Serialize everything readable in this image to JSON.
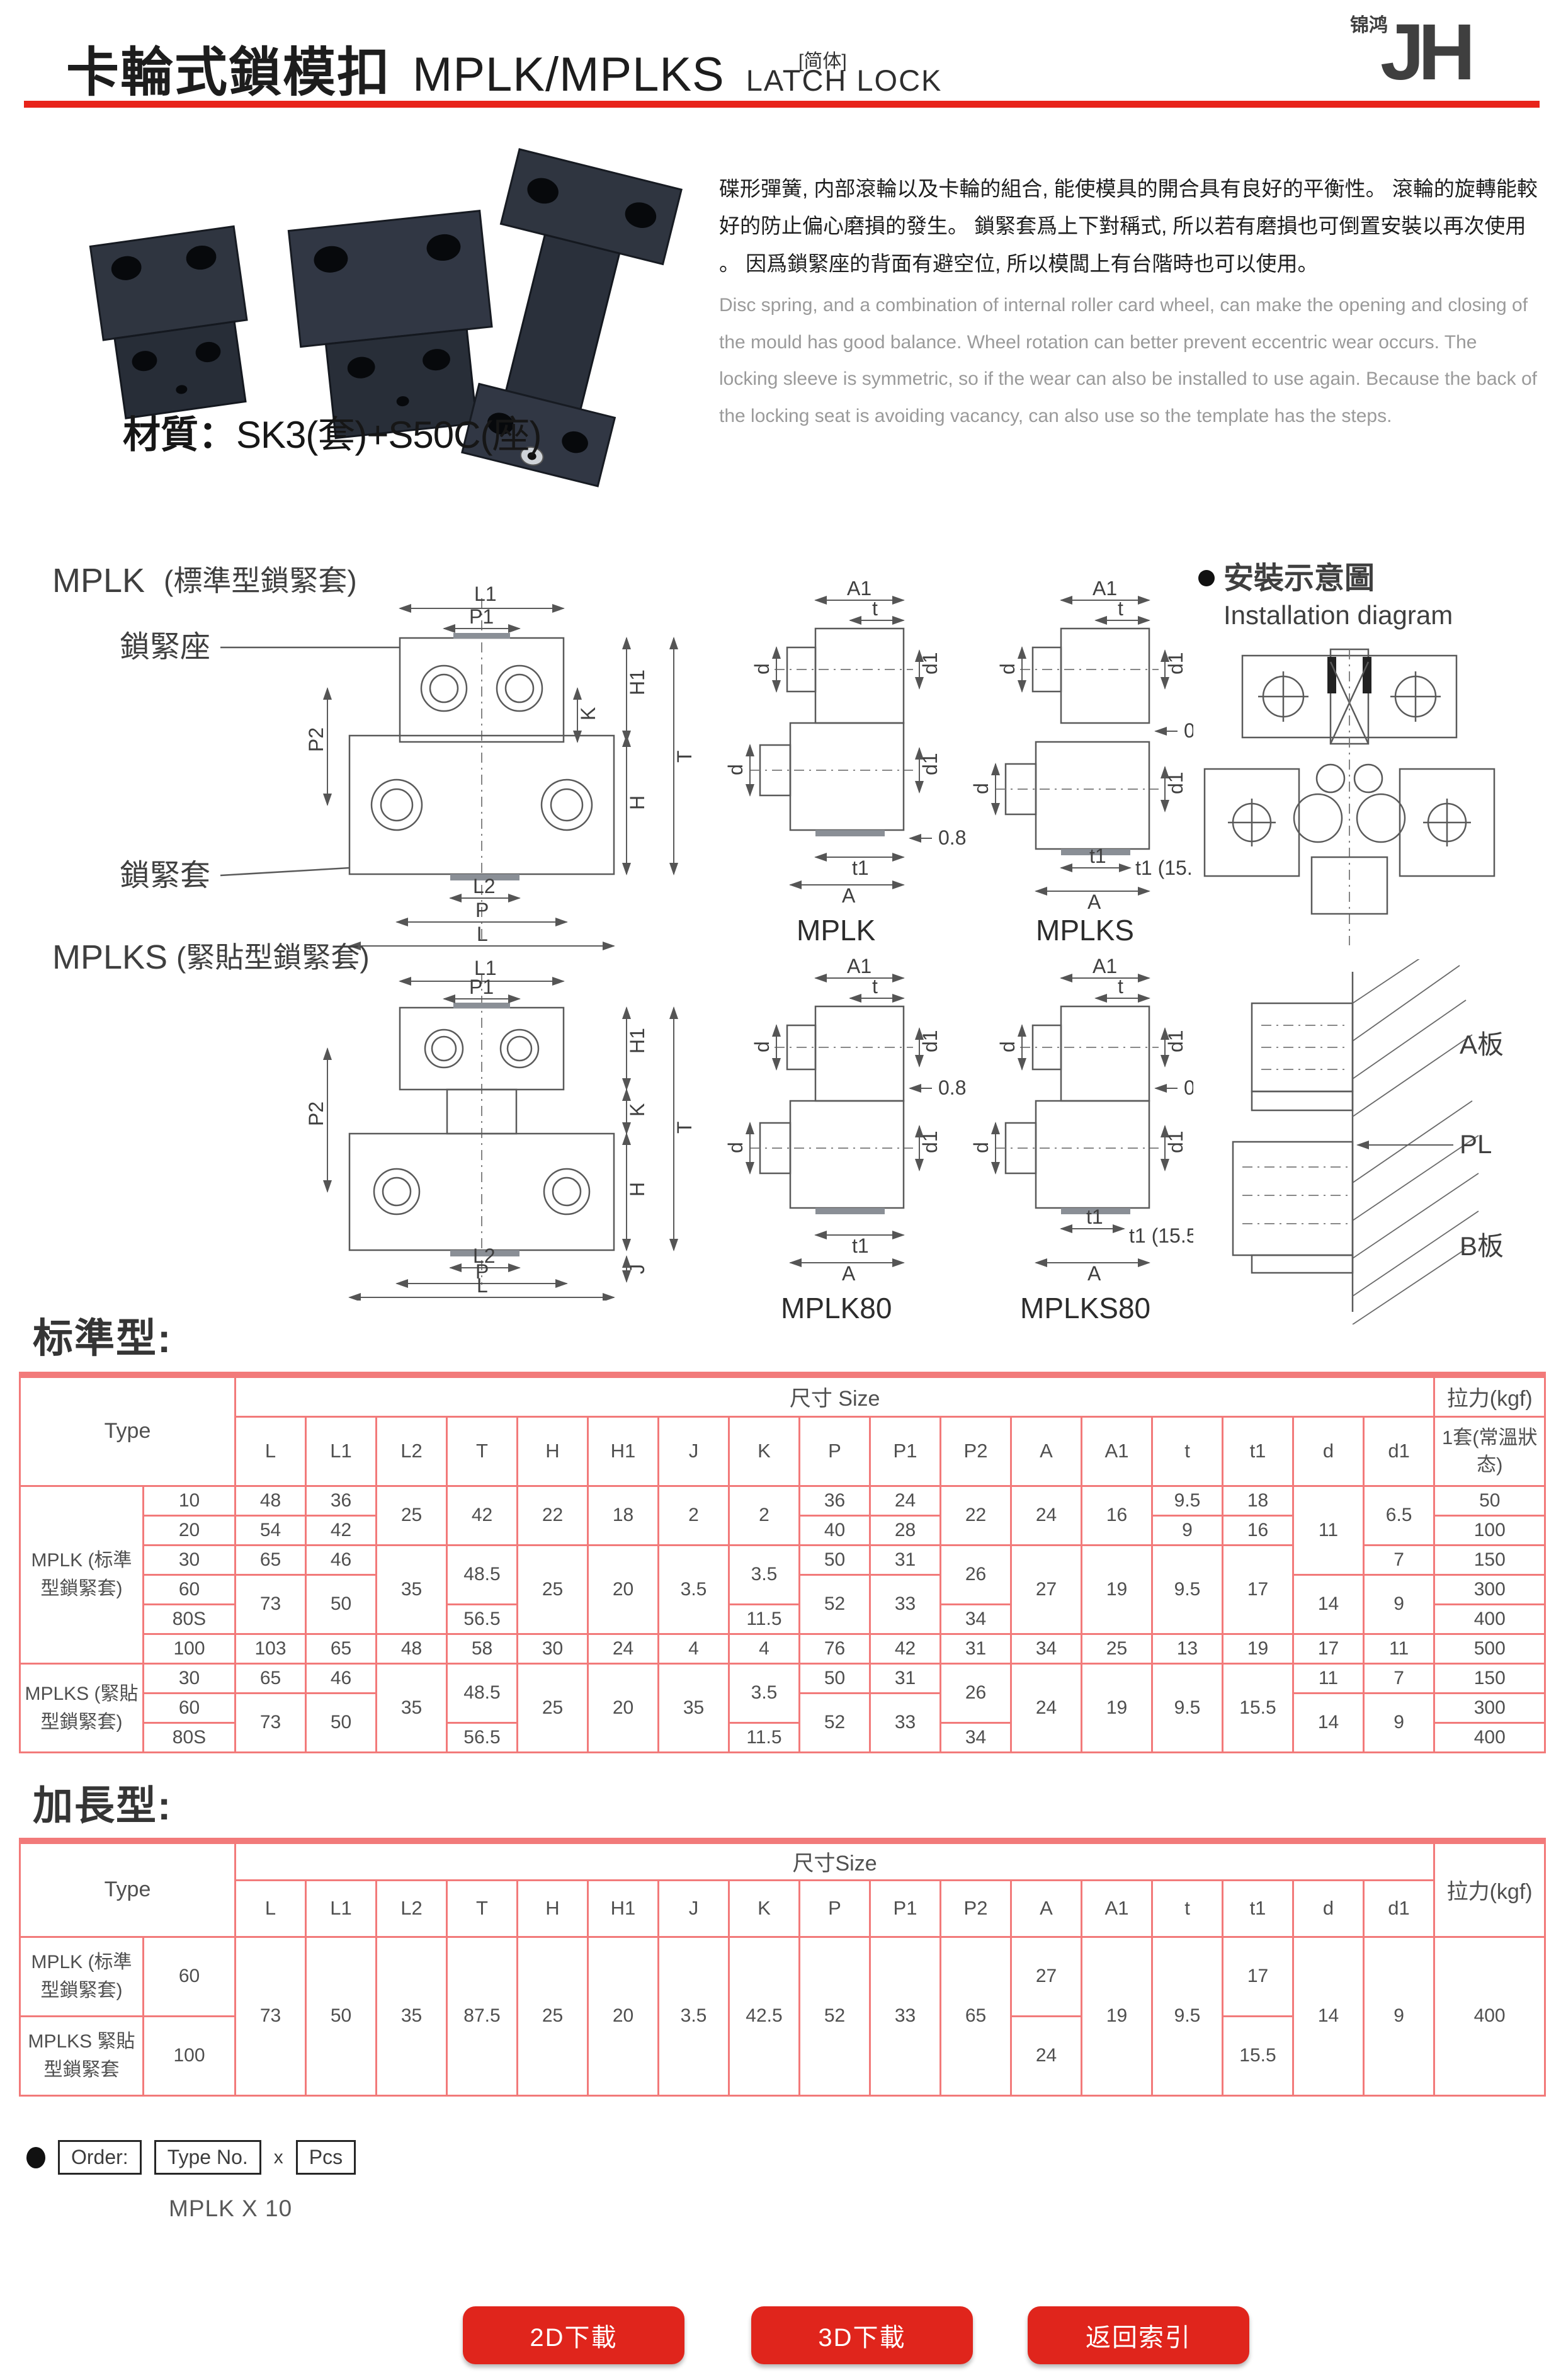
{
  "header": {
    "title_zh": "卡輪式鎖模扣",
    "title_model": "MPLK/MPLKS",
    "title_en": "LATCH LOCK",
    "lang_tag": "[简体]",
    "logo_jh": "JH",
    "logo_cn": "锦鸿"
  },
  "intro": {
    "desc_zh": "碟形彈簧, 内部滾輪以及卡輪的組合, 能使模具的開合具有良好的平衡性。 滾輪的旋轉能較好的防止偏心磨損的發生。 鎖緊套爲上下對稱式, 所以若有磨損也可倒置安裝以再次使用 。 因爲鎖緊座的背面有避空位, 所以模闆上有台階時也可以使用。",
    "desc_en": "Disc spring, and a combination of internal roller card wheel, can make the opening and closing of the mould has good balance. Wheel rotation can better prevent eccentric wear occurs. The locking sleeve is symmetric, so if the wear can also be installed to use again. Because the back of the locking seat is avoiding vacancy, can also use so the template has the steps.",
    "material_label": "材質：",
    "material_value": "SK3(套)+S50C(座)"
  },
  "dims": {
    "L": "L",
    "L1": "L1",
    "L2": "L2",
    "T": "T",
    "H": "H",
    "H1": "H1",
    "J": "J",
    "K": "K",
    "P": "P",
    "P1": "P1",
    "P2": "P2",
    "A": "A",
    "A1": "A1",
    "t": "t",
    "t1": "t1",
    "d": "d",
    "d1": "d1",
    "gap": "0.8",
    "t1_155": "t1 (15.5)"
  },
  "drawings": {
    "mplk_title": "MPLK",
    "mplk_sub": "(標準型鎖緊套)",
    "mplks_title": "MPLKS",
    "mplks_sub": "(緊貼型鎖緊套)",
    "seat_label": "鎖緊座",
    "sleeve_label": "鎖緊套",
    "cap_mplk": "MPLK",
    "cap_mplks": "MPLKS",
    "cap_mplk80": "MPLK80",
    "cap_mplks80": "MPLKS80",
    "install_zh": "安裝示意圖",
    "install_en": "Installation diagram",
    "plate_a": "A板",
    "pl": "PL",
    "plate_b": "B板"
  },
  "table_standard": {
    "heading": "标準型:",
    "type_header": "Type",
    "size_header": "尺寸 Size",
    "pull_header": "拉力(kgf)",
    "pull_sub": "1套(常溫狀态)",
    "cols": [
      "L",
      "L1",
      "L2",
      "T",
      "H",
      "H1",
      "J",
      "K",
      "P",
      "P1",
      "P2",
      "A",
      "A1",
      "t",
      "t1",
      "d",
      "d1"
    ],
    "group_mplk": "MPLK (标準型鎖緊套)",
    "group_mplks": "MPLKS (緊貼型鎖緊套)",
    "rows": {
      "m10": {
        "size": "10",
        "L": "48",
        "L1": "36",
        "L2": "25",
        "T": "42",
        "H": "22",
        "H1": "18",
        "J": "2",
        "K": "2",
        "P": "36",
        "P1": "24",
        "P2": "22",
        "A": "24",
        "A1": "16",
        "t": "9.5",
        "t1": "18",
        "d": "11",
        "d1": "6.5",
        "pull": "50"
      },
      "m20": {
        "size": "20",
        "L": "54",
        "L1": "42",
        "P": "40",
        "P1": "28",
        "t": "9",
        "t1": "16",
        "pull": "100"
      },
      "m30": {
        "size": "30",
        "L": "65",
        "L1": "46",
        "L2": "35",
        "T": "48.5",
        "H": "25",
        "H1": "20",
        "J": "3.5",
        "K": "3.5",
        "P": "50",
        "P1": "31",
        "P2": "26",
        "A": "27",
        "A1": "19",
        "t": "9.5",
        "t1": "17",
        "d1": "7",
        "pull": "150"
      },
      "m60": {
        "size": "60",
        "L": "73",
        "L1": "50",
        "P": "52",
        "P1": "33",
        "d": "14",
        "d1": "9",
        "pull": "300"
      },
      "m80": {
        "size": "80S",
        "T": "56.5",
        "K": "11.5",
        "P2": "34",
        "pull": "400"
      },
      "m100": {
        "size": "100",
        "L": "103",
        "L1": "65",
        "L2": "48",
        "T": "58",
        "H": "30",
        "H1": "24",
        "J": "4",
        "K": "4",
        "P": "76",
        "P1": "42",
        "P2": "31",
        "A": "34",
        "A1": "25",
        "t": "13",
        "t1": "19",
        "d": "17",
        "d1": "11",
        "pull": "500"
      },
      "s30": {
        "size": "30",
        "L": "65",
        "L1": "46",
        "L2": "35",
        "T": "48.5",
        "H": "25",
        "H1": "20",
        "J": "35",
        "K": "3.5",
        "P": "50",
        "P1": "31",
        "P2": "26",
        "A": "24",
        "A1": "19",
        "t": "9.5",
        "t1": "15.5",
        "d": "11",
        "d1": "7",
        "pull": "150"
      },
      "s60": {
        "size": "60",
        "L": "73",
        "L1": "50",
        "P": "52",
        "P1": "33",
        "d": "14",
        "d1": "9",
        "pull": "300"
      },
      "s80": {
        "size": "80S",
        "T": "56.5",
        "K": "11.5",
        "P2": "34",
        "pull": "400"
      }
    }
  },
  "table_extended": {
    "heading": "加長型:",
    "type_header": "Type",
    "size_header": "尺寸Size",
    "pull_header": "拉力(kgf)",
    "cols": [
      "L",
      "L1",
      "L2",
      "T",
      "H",
      "H1",
      "J",
      "K",
      "P",
      "P1",
      "P2",
      "A",
      "A1",
      "t",
      "t1",
      "d",
      "d1"
    ],
    "rows": {
      "mplk": {
        "group": "MPLK (标準型鎖緊套)",
        "size": "60",
        "L": "73",
        "L1": "50",
        "L2": "35",
        "T": "87.5",
        "H": "25",
        "H1": "20",
        "J": "3.5",
        "K": "42.5",
        "P": "52",
        "P1": "33",
        "P2": "65",
        "A": "27",
        "A1": "19",
        "t": "9.5",
        "t1": "17",
        "d": "14",
        "d1": "9",
        "pull": "400"
      },
      "mplks": {
        "group": "MPLKS 緊貼型鎖緊套",
        "size": "100",
        "A": "24",
        "t1": "15.5"
      }
    }
  },
  "order": {
    "label": "Order:",
    "type_no": "Type No.",
    "times": "x",
    "pcs": "Pcs",
    "example": "MPLK X 10"
  },
  "buttons": {
    "b2d": "2D下載",
    "b3d": "3D下載",
    "back": "返回索引"
  },
  "colors": {
    "accent_red": "#e8231a",
    "table_border": "#f27a7a",
    "button_red": "#e0251c",
    "logo_red": "#e60012"
  }
}
